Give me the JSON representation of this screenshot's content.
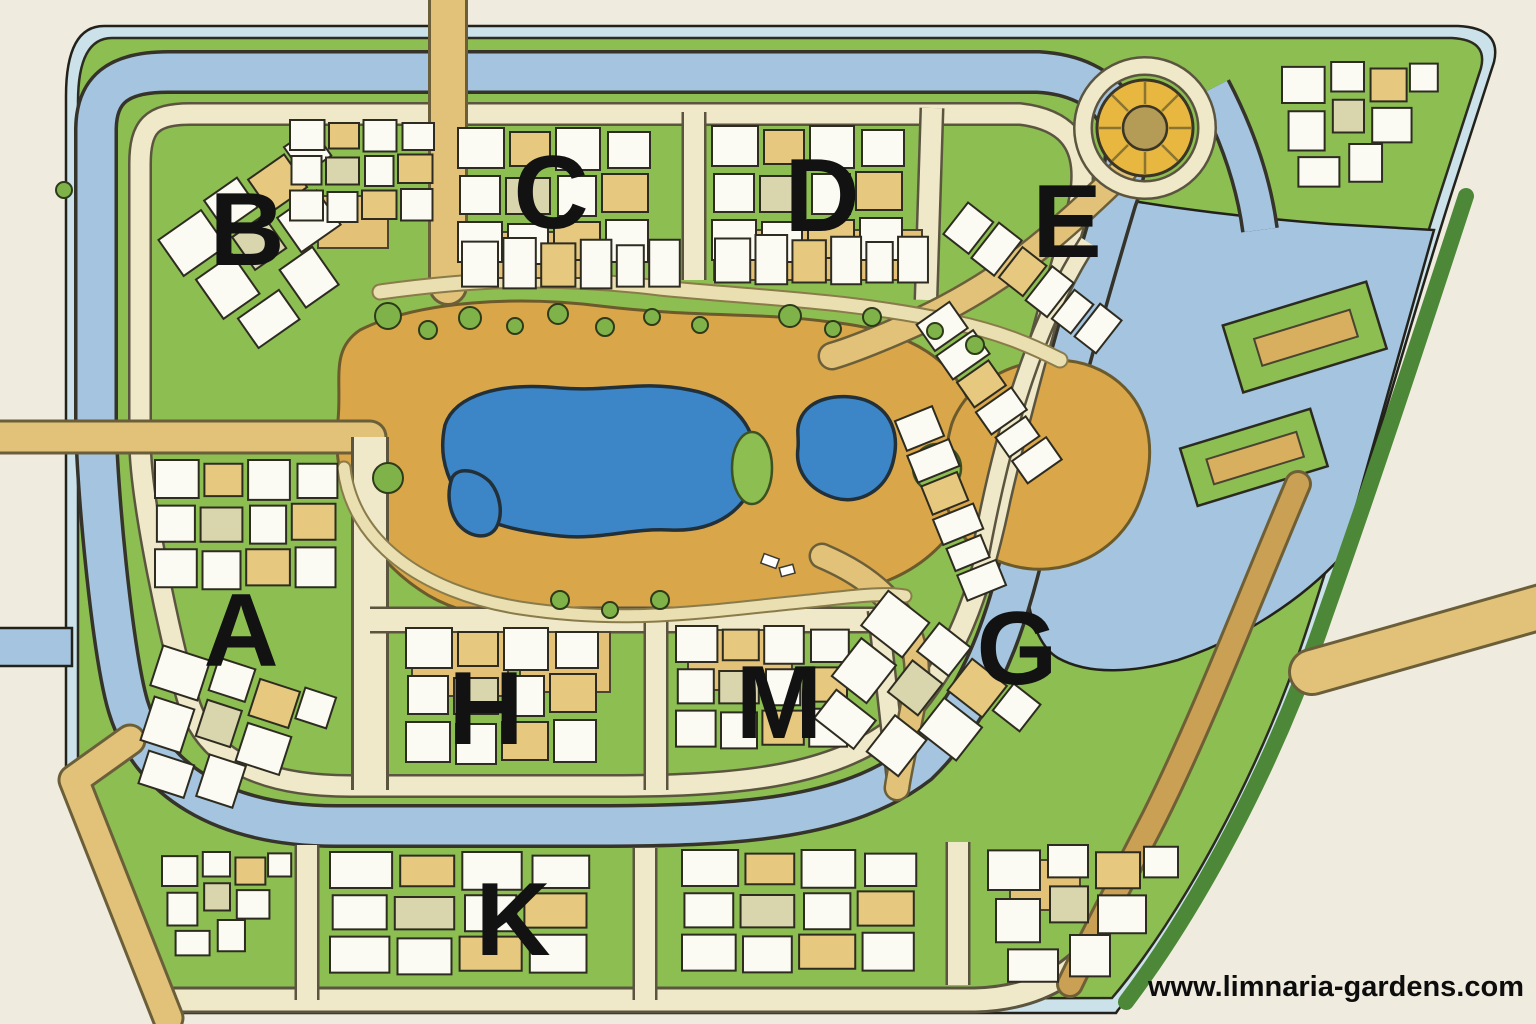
{
  "watermark": {
    "url_text": "www.limnaria-gardens.com"
  },
  "districts": [
    {
      "label": "B"
    },
    {
      "label": "C"
    },
    {
      "label": "D"
    },
    {
      "label": "E"
    },
    {
      "label": "A"
    },
    {
      "label": "G"
    },
    {
      "label": "H"
    },
    {
      "label": "M"
    },
    {
      "label": "K"
    }
  ],
  "colors": {
    "background": "#F0EBDF",
    "rim_water": "#CBE2EB",
    "canal_water": "#A4C4DF",
    "lake_water": "#3C86C8",
    "grass": "#8CBE52",
    "hedge_green": "#4C8838",
    "sand": "#D9A64A",
    "road_cream": "#EFE8C9",
    "road_tan": "#E2C179",
    "roundabout_yellow": "#E8B73F",
    "building_white": "#FBFAF3",
    "building_tan": "#E6C87F",
    "outline_ink": "#2E2C20",
    "label_text": "#121212"
  }
}
